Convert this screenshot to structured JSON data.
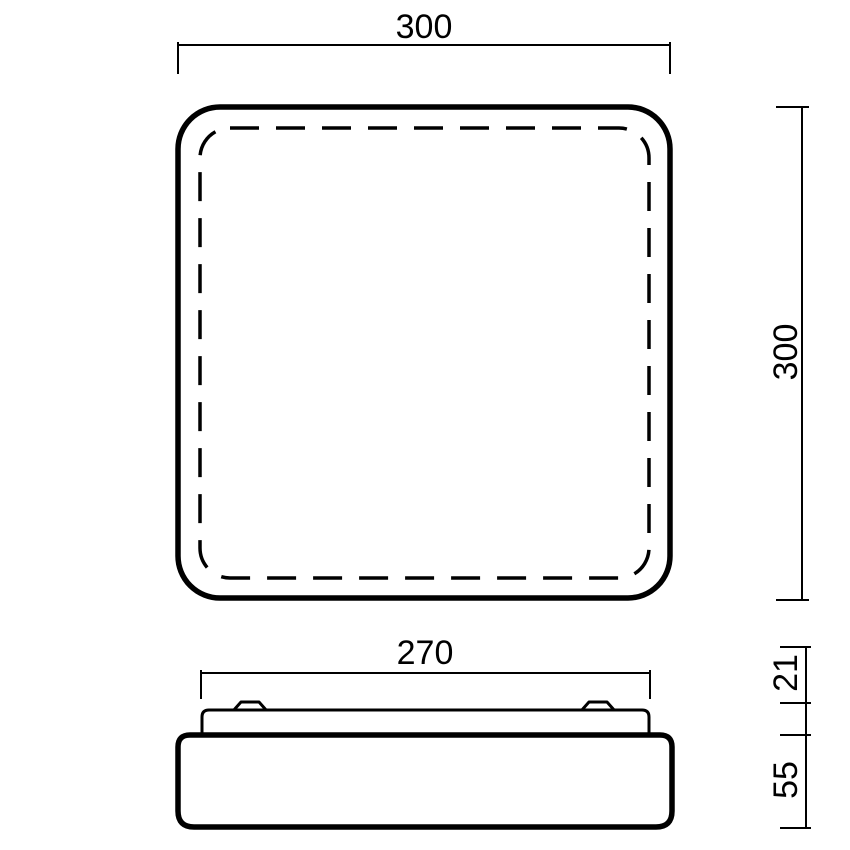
{
  "canvas": {
    "background": "#ffffff",
    "line_color": "#000000"
  },
  "drawing": {
    "type": "technical-dimension-drawing",
    "views": [
      {
        "id": "plan-view",
        "shape": "rounded-square with dashed inner diffuser line"
      },
      {
        "id": "profile-view",
        "shape": "mounting plate with two clips over fixture body"
      }
    ]
  },
  "labels": {
    "plan_width": "300",
    "plan_height": "300",
    "profile_width": "270",
    "profile_upper_height": "21",
    "profile_lower_height": "55"
  }
}
